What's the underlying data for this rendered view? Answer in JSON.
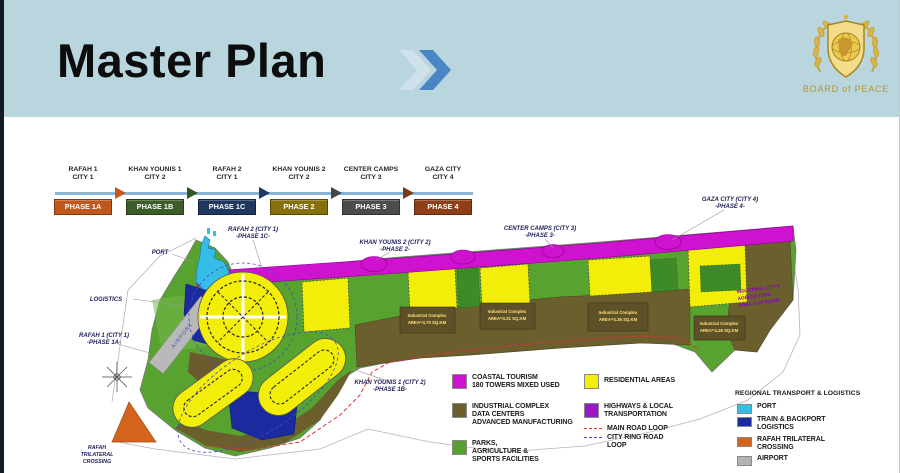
{
  "colors": {
    "header_bg": "#b9d5de",
    "accent_blue": "#4a86c4",
    "coastal_tourism": "#cf12cf",
    "residential": "#f2ee0a",
    "industrial": "#6b5f2e",
    "parks": "#55a02e",
    "highways": "#9b17c8",
    "port": "#35bde8",
    "train_logistics": "#1b2a9e",
    "rafah_crossing": "#d4641c",
    "airport": "#b3b3b3"
  },
  "header": {
    "title": "Master Plan",
    "logo_text": "BOARD of PEACE"
  },
  "timeline": {
    "items": [
      {
        "name": "RAFAH 1",
        "city": "CITY 1",
        "phase": "PHASE 1A",
        "phase_color": "#c0571d",
        "arrow_color": "#c4581c"
      },
      {
        "name": "KHAN YOUNIS 1",
        "city": "CITY 2",
        "phase": "PHASE 1B",
        "phase_color": "#3c5c28",
        "arrow_color": "#375623"
      },
      {
        "name": "RAFAH 2",
        "city": "CITY 1",
        "phase": "PHASE 1C",
        "phase_color": "#20375f",
        "arrow_color": "#203864"
      },
      {
        "name": "KHAN YOUNIS 2",
        "city": "CITY 2",
        "phase": "PHASE 2",
        "phase_color": "#85700a",
        "arrow_color": "#474747"
      },
      {
        "name": "CENTER CAMPS",
        "city": "CITY 3",
        "phase": "PHASE 3",
        "phase_color": "#4c4c4a",
        "arrow_color": "#7b3a12"
      },
      {
        "name": "GAZA CITY",
        "city": "CITY 4",
        "phase": "PHASE 4",
        "phase_color": "#8f3f17",
        "arrow_color": ""
      }
    ]
  },
  "map": {
    "labels": {
      "port": "PORT",
      "logistics": "LOGISTICS",
      "airport": "AIRPORT",
      "rafah1": [
        "RAFAH 1 (CITY 1)",
        "-PHASE 1A-"
      ],
      "rafah2": [
        "RAFAH 2 (CITY 1)",
        "-PHASE 1C-"
      ],
      "khanyounis2": [
        "KHAN YOUNIS 2 (CITY 2)",
        "-PHASE 2-"
      ],
      "centercamps": [
        "CENTER CAMPS (CITY 3)",
        "-PHASE 3-"
      ],
      "gazacity": [
        "GAZA CITY (CITY 4)",
        "-PHASE 4-"
      ],
      "khanyounis1": [
        "KHAN YOUNIS 1 (CITY 2)",
        "-PHASE 1B-"
      ],
      "crossing": [
        "RAFAH",
        "TRILATERAL",
        "CROSSING"
      ]
    },
    "industrial_boxes": [
      {
        "title": "Industrial Complex",
        "area": "AREA=4.70 SQ.KM"
      },
      {
        "title": "Industrial Complex",
        "area": "AREA=4.31 SQ.KM"
      },
      {
        "title": "Industrial Complex",
        "area": "AREA=4.36 SQ.KM"
      },
      {
        "title": "Industrial Complex",
        "area": "AREA=4.26 SQ.KM"
      }
    ],
    "right_text": [
      "INDUSTRIAL CITY'S",
      "AGRICULTURE",
      "AREA=4.49 SQ.KM"
    ]
  },
  "legend": {
    "land_use": [
      {
        "color": "#cf12cf",
        "lines": [
          "COASTAL TOURISM",
          "180 TOWERS MIXED USED"
        ]
      },
      {
        "color": "#6b5f2e",
        "lines": [
          "INDUSTRIAL COMPLEX",
          "DATA CENTERS",
          "ADVANCED MANUFACTURING"
        ]
      },
      {
        "color": "#55a02e",
        "lines": [
          "PARKS,",
          "AGRICULTURE &",
          "SPORTS FACILITIES"
        ]
      },
      {
        "color": "#f2ee0a",
        "lines": [
          "RESIDENTIAL AREAS"
        ]
      },
      {
        "color": "#9b17c8",
        "lines": [
          "HIGHWAYS & LOCAL",
          "TRANSPORTATION"
        ]
      }
    ],
    "roads": [
      {
        "color": "#e03030",
        "lines": [
          "MAIN ROAD LOOP"
        ]
      },
      {
        "color": "#3a4ed0",
        "lines": [
          "CITY RING ROAD",
          "LOOP"
        ]
      }
    ],
    "regional": {
      "title": "REGIONAL TRANSPORT & LOGISTICS",
      "items": [
        {
          "color": "#35bde8",
          "lines": [
            "PORT"
          ]
        },
        {
          "color": "#1b2a9e",
          "lines": [
            "TRAIN & BACKPORT",
            "LOGISTICS"
          ]
        },
        {
          "color": "#d4641c",
          "lines": [
            "RAFAH TRILATERAL",
            "CROSSING"
          ]
        },
        {
          "color": "#b3b3b3",
          "lines": [
            "AIRPORT"
          ]
        }
      ]
    }
  }
}
